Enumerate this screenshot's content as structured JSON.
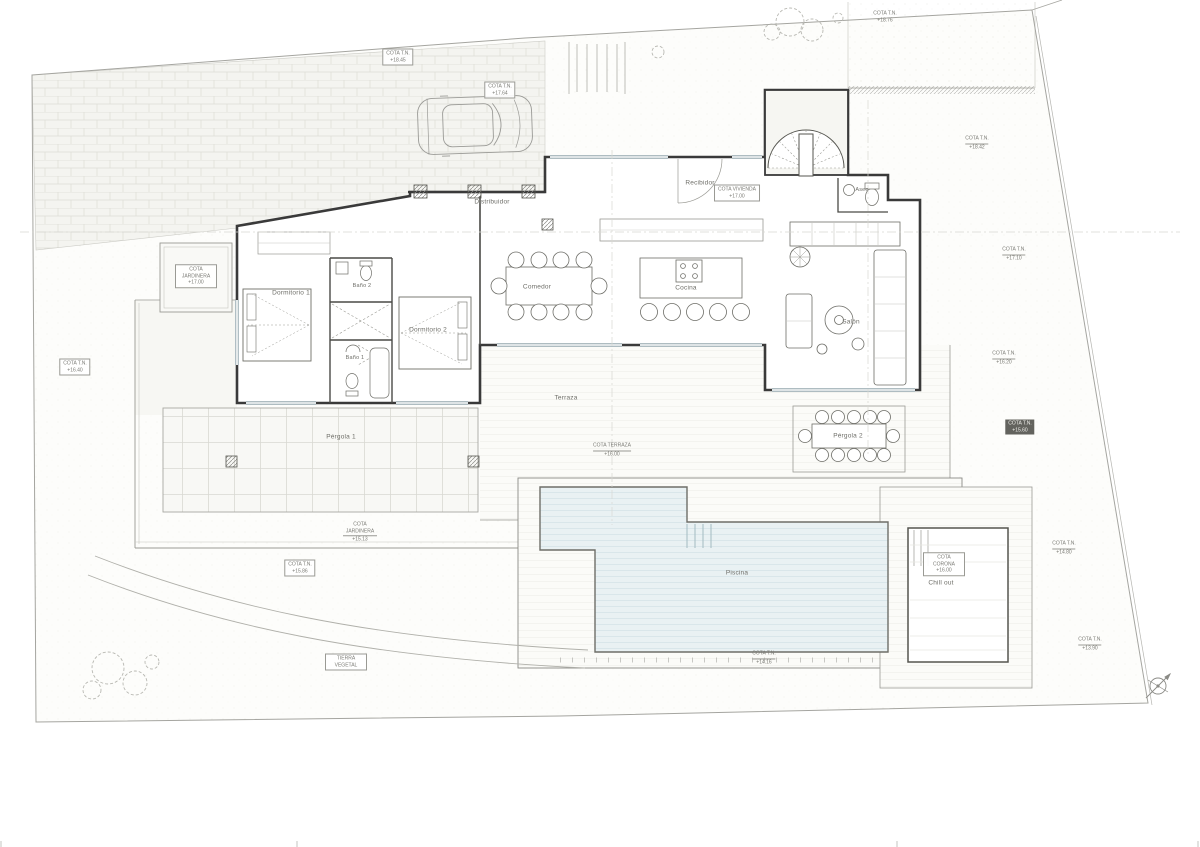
{
  "drawing": {
    "type": "floor-plan",
    "language": "es",
    "rooms": [
      {
        "id": "recibidor",
        "label": "Recibidor"
      },
      {
        "id": "distribuidor",
        "label": "Distribuidor"
      },
      {
        "id": "comedor",
        "label": "Comedor"
      },
      {
        "id": "cocina",
        "label": "Cocina"
      },
      {
        "id": "salon",
        "label": "Salón"
      },
      {
        "id": "aseo",
        "label": "Aseo"
      },
      {
        "id": "dormitorio1",
        "label": "Dormitorio 1"
      },
      {
        "id": "bano2",
        "label": "Baño 2"
      },
      {
        "id": "bano1",
        "label": "Baño 1"
      },
      {
        "id": "dormitorio2",
        "label": "Dormitorio 2"
      },
      {
        "id": "terraza",
        "label": "Terraza"
      },
      {
        "id": "pergola1",
        "label": "Pérgola 1"
      },
      {
        "id": "pergola2",
        "label": "Pérgola 2"
      },
      {
        "id": "piscina",
        "label": "Piscina"
      },
      {
        "id": "chillout",
        "label": "Chill out"
      }
    ],
    "annotations": [
      {
        "label": "COTA T.N.",
        "value": "+18.45"
      },
      {
        "label": "COTA T.N.",
        "value": "+17.64"
      },
      {
        "label": "COTA JARDINERA",
        "value": "+17.00"
      },
      {
        "label": "COTA T.N.",
        "value": "+16.40"
      },
      {
        "label": "COTA VIVIENDA",
        "value": "+17.00"
      },
      {
        "label": "COTA T.N.",
        "value": "+18.76"
      },
      {
        "label": "COTA T.N.",
        "value": "+18.42"
      },
      {
        "label": "COTA T.N.",
        "value": "+17.10"
      },
      {
        "label": "COTA T.N.",
        "value": "+16.20"
      },
      {
        "label": "COTA T.N.",
        "value": "+15.60"
      },
      {
        "label": "COTA TERRAZA",
        "value": "+16.00"
      },
      {
        "label": "COTA JARDINERA",
        "value": "+15.13"
      },
      {
        "label": "COTA T.N.",
        "value": "+15.86"
      },
      {
        "label": "TIERRA VEGETAL",
        "value": ""
      },
      {
        "label": "COTA CORONA",
        "value": "+16.00"
      },
      {
        "label": "COTA T.N.",
        "value": "+14.16"
      },
      {
        "label": "COTA T.N.",
        "value": "+14.80"
      },
      {
        "label": "COTA T.N.",
        "value": "+13.90"
      }
    ],
    "icons": {
      "car": "top-view-car",
      "staircase": "fan-staircase",
      "trees": "scribble-canopy",
      "north_arrow": "compass-cross"
    },
    "colors": {
      "pool_fill": "#e9f1f3",
      "pool_stripe": "#c9dce1",
      "wall": "#3a3a3a",
      "light_line": "#b0b0aa",
      "paving_line": "#ddddd6",
      "text": "#6e6e68"
    }
  }
}
